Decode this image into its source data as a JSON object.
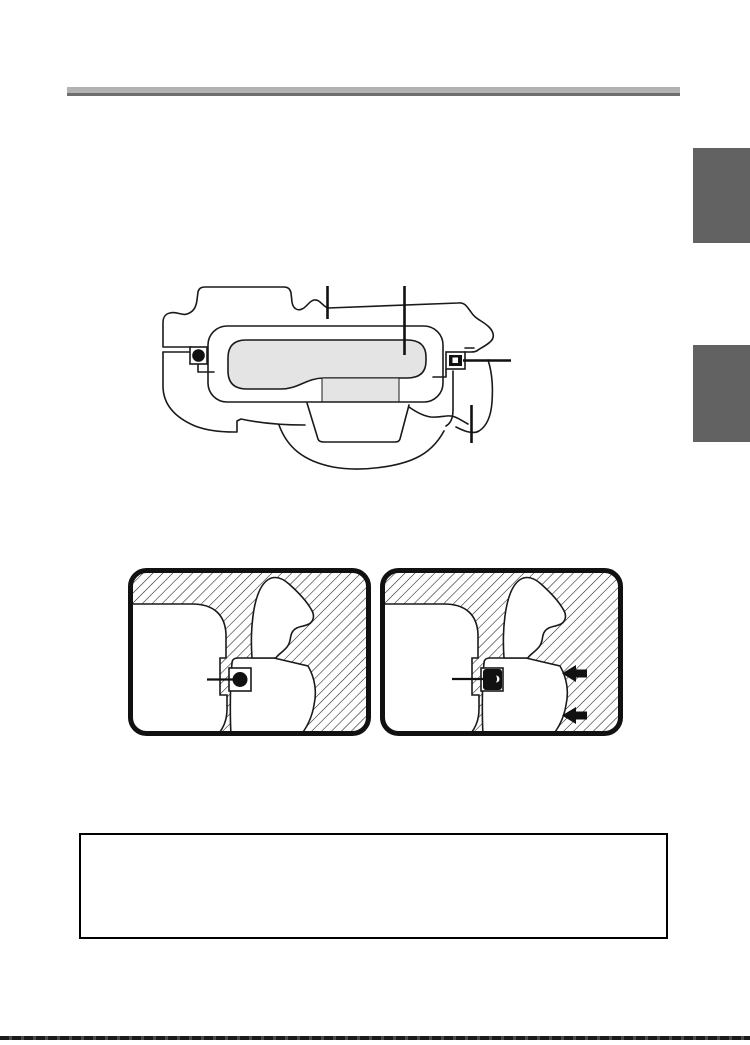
{
  "page": {
    "kind": "scanned-manual-page",
    "background_color": "#ffffff",
    "header_rule": {
      "light_color": "#b2b2b2",
      "dark_color": "#6e6e6e"
    },
    "side_tabs": [
      {
        "id": "tab-upper",
        "color": "#626262"
      },
      {
        "id": "tab-lower",
        "color": "#626262"
      }
    ],
    "page_edge_color": "#1b1b1b"
  },
  "main_diagram": {
    "name": "device-body-cross-section",
    "line_color": "#1a1a1a",
    "cavity_fill_color": "#e4e4e4",
    "seal_color": "#111111",
    "callout_lines": [
      "top-left-vertical",
      "top-center-vertical",
      "right-horizontal",
      "bottom-right-vertical"
    ]
  },
  "detail_panels": [
    {
      "id": "seal-detail-open",
      "hatched": true,
      "oring_state": "round",
      "arrows": []
    },
    {
      "id": "seal-detail-sealed",
      "hatched": true,
      "oring_state": "compressed",
      "arrows": [
        "upper-left-arrow",
        "lower-left-arrow"
      ]
    }
  ],
  "note_box": {
    "border_color": "#000000",
    "text": ""
  }
}
